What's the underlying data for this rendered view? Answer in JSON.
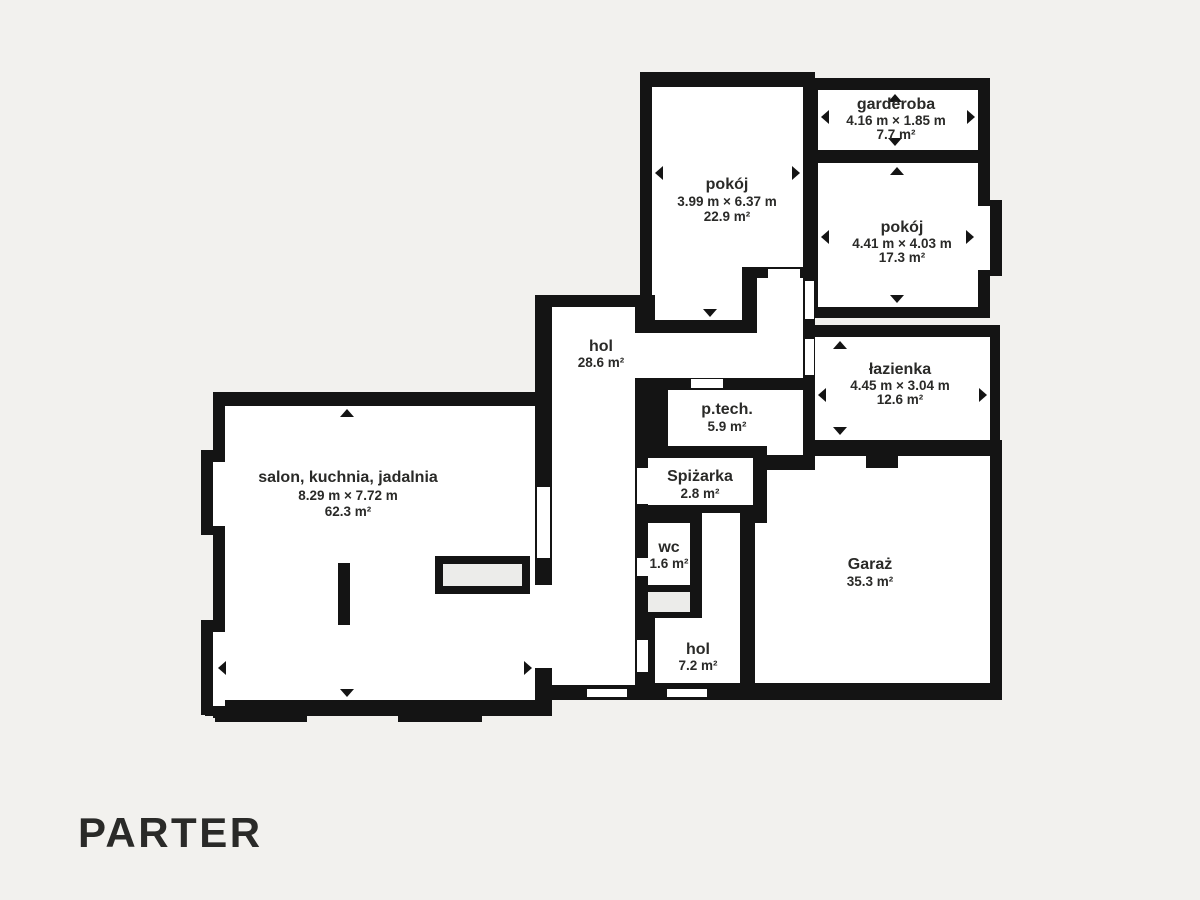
{
  "floor_label": "PARTER",
  "rooms": {
    "pokoj_a": {
      "name": "pokój",
      "dims": "3.99 m × 6.37 m",
      "area": "22.9 m²"
    },
    "garderoba": {
      "name": "garderoba",
      "dims": "4.16 m × 1.85 m",
      "area": "7.7 m²"
    },
    "pokoj_b": {
      "name": "pokój",
      "dims": "4.41 m × 4.03 m",
      "area": "17.3 m²"
    },
    "lazienka": {
      "name": "łazienka",
      "dims": "4.45 m × 3.04 m",
      "area": "12.6 m²"
    },
    "ptech": {
      "name": "p.tech.",
      "area": "5.9 m²"
    },
    "spizarka": {
      "name": "Spiżarka",
      "area": "2.8 m²"
    },
    "wc": {
      "name": "wc",
      "area": "1.6 m²"
    },
    "hol_main": {
      "name": "hol",
      "area": "28.6 m²"
    },
    "hol_small": {
      "name": "hol",
      "area": "7.2 m²"
    },
    "garaz": {
      "name": "Garaż",
      "area": "35.3 m²"
    },
    "salon": {
      "name": "salon, kuchnia, jadalnia",
      "dims": "8.29 m × 7.72 m",
      "area": "62.3 m²"
    }
  },
  "colors": {
    "background": "#f2f1ee",
    "wall": "#141414",
    "room": "#ffffff",
    "niche": "#ececea",
    "text": "#2a2a28"
  }
}
